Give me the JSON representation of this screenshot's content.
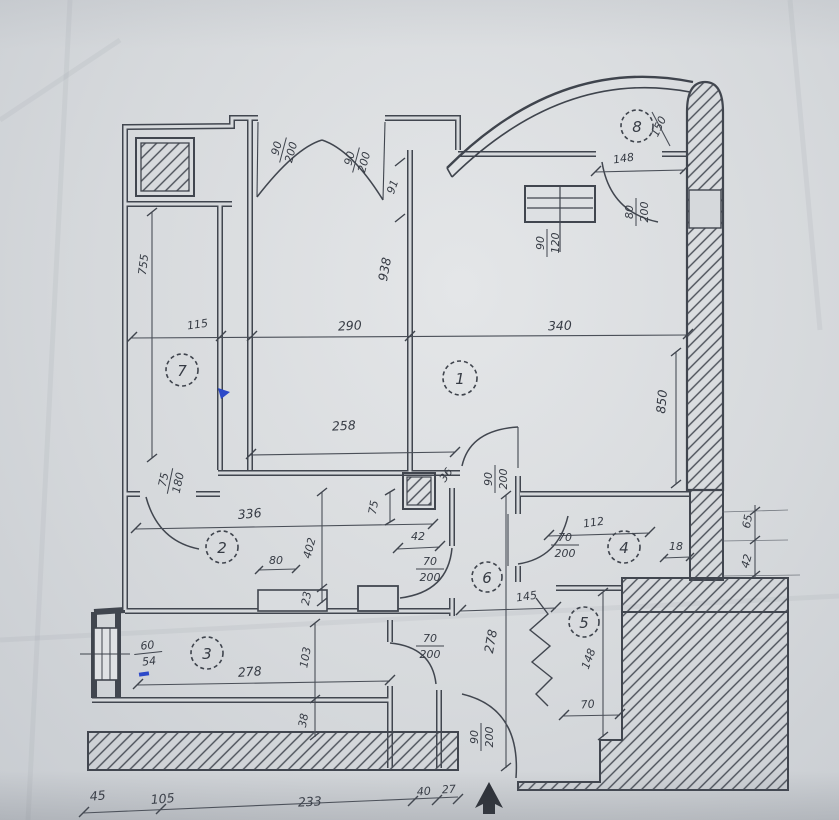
{
  "plan": {
    "palette": {
      "paper": "#d6d9dc",
      "ink": "#41464f",
      "pen_blue": "#2c49c9"
    },
    "rooms": [
      {
        "number": "1"
      },
      {
        "number": "2"
      },
      {
        "number": "3"
      },
      {
        "number": "4"
      },
      {
        "number": "5"
      },
      {
        "number": "6"
      },
      {
        "number": "7"
      },
      {
        "number": "8"
      }
    ],
    "door_labels": [
      {
        "num": "90",
        "den": "200"
      },
      {
        "num": "90",
        "den": "200"
      },
      {
        "num": "80",
        "den": "200"
      },
      {
        "num": "90",
        "den": "120"
      },
      {
        "num": "75",
        "den": "180"
      },
      {
        "num": "90",
        "den": "200"
      },
      {
        "num": "70",
        "den": "200"
      },
      {
        "num": "70",
        "den": "200"
      },
      {
        "num": "70",
        "den": "200"
      },
      {
        "num": "90",
        "den": "200"
      },
      {
        "num": "60",
        "den": "54"
      }
    ],
    "dims": [
      {
        "id": "upper-segment",
        "text": "91"
      },
      {
        "id": "total-height",
        "text": "938"
      },
      {
        "id": "balcony8-width",
        "text": "148"
      },
      {
        "id": "balcony8-depth",
        "text": "150"
      },
      {
        "id": "bedroom-width",
        "text": "290"
      },
      {
        "id": "room1-width",
        "text": "340"
      },
      {
        "id": "balcony7-length",
        "text": "755"
      },
      {
        "id": "balcony7-width",
        "text": "115"
      },
      {
        "id": "room1-height",
        "text": "850"
      },
      {
        "id": "bedroom-inner",
        "text": "258"
      },
      {
        "id": "room2-width",
        "text": "336"
      },
      {
        "id": "wall-stub",
        "text": "75"
      },
      {
        "id": "door-offset",
        "text": "36"
      },
      {
        "id": "shaft-width",
        "text": "42"
      },
      {
        "id": "room2-height",
        "text": "402"
      },
      {
        "id": "niche-width",
        "text": "80"
      },
      {
        "id": "niche-depth",
        "text": "23"
      },
      {
        "id": "room4-width",
        "text": "112"
      },
      {
        "id": "room4-offset",
        "text": "18"
      },
      {
        "id": "right-step-a",
        "text": "65"
      },
      {
        "id": "right-step-b",
        "text": "42"
      },
      {
        "id": "hall-width",
        "text": "145"
      },
      {
        "id": "corridor-height",
        "text": "278"
      },
      {
        "id": "room5-height",
        "text": "148"
      },
      {
        "id": "room5-width",
        "text": "70"
      },
      {
        "id": "room3-width",
        "text": "278"
      },
      {
        "id": "room3-height",
        "text": "103"
      },
      {
        "id": "room3-wall",
        "text": "38"
      },
      {
        "id": "bottom-40",
        "text": "40"
      },
      {
        "id": "bottom-27",
        "text": "27"
      },
      {
        "id": "bottom-233",
        "text": "233"
      },
      {
        "id": "bottom-105",
        "text": "105"
      },
      {
        "id": "bottom-45",
        "text": "45"
      }
    ]
  }
}
